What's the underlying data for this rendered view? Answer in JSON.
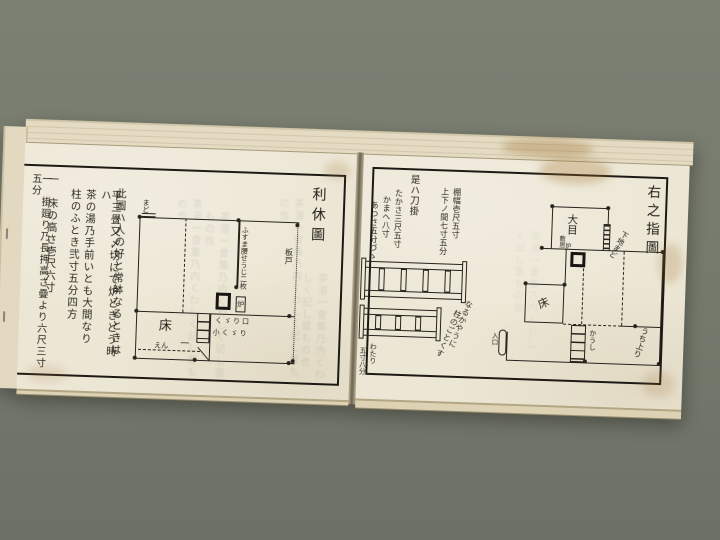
{
  "colors": {
    "background": "#7c8073",
    "page": "#ece6d4",
    "ink": "#26231d",
    "page_edge": "#e4dbc2",
    "stain": "#a97f37"
  },
  "book": {
    "left_page": {
      "title": "利休圖",
      "text_columns": [
        "此圖ハ人の好と常躰なるときは",
        "平三畳又〆切にて炉ときどう時ハ",
        "茶の湯乃手前いとも大間なり",
        "柱のふとき弐寸五分四方",
        "一　床の高さ壱尺六寸",
        "一　掛廻り乃長押高さ疊より六尺三寸五分"
      ],
      "plan": {
        "alcove_label": "床",
        "hearth_label": "炉",
        "partition_label": "ふすま腰せうじ二枚",
        "board_door_label": "板戸",
        "window_label": "まど",
        "crawl_door_label": "くゞり口",
        "small_crawl_label": "小くゞり",
        "veranda_label": "えん",
        "tick_label": "一"
      }
    },
    "right_page": {
      "title": "右之指圖",
      "captions": {
        "header": "是ハ刀掛",
        "shelf_width": "棚幅壱尺五寸",
        "gap": "上下ノ間七寸五分",
        "height": "たかさ三尺五寸",
        "frame": "かまへ八寸",
        "thickness": "あつさ五分づゝ",
        "span_a": "わたり",
        "span_b": "五寸八分",
        "note_a": "なるかやうに",
        "note_b": "柱のごとくす"
      },
      "plan": {
        "daime_label": "大目",
        "sill_label": "敷居",
        "hearth_label": "炉",
        "window_note": "下地まど",
        "alcove_label": "床",
        "entrance_label": "入口",
        "lattice_label": "かうし",
        "step_note": "うち上り"
      }
    },
    "show_through": "茶湯一會集乃内くわしく記し置もの也"
  }
}
